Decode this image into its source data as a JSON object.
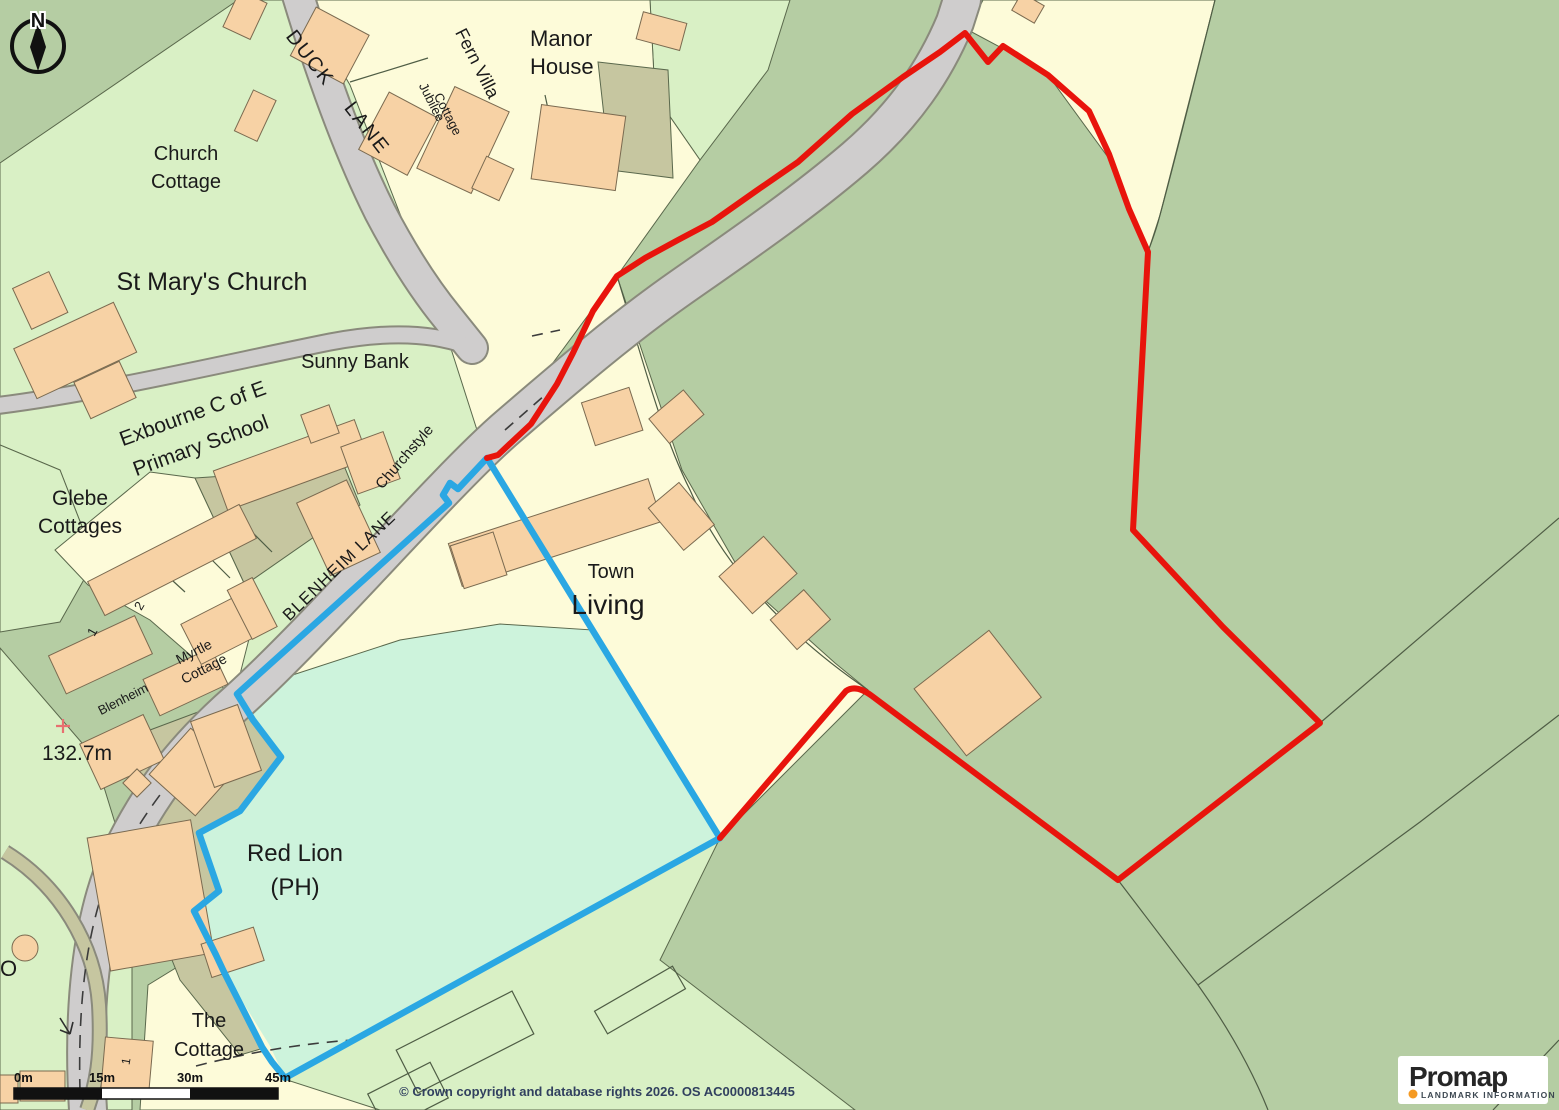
{
  "map_labels": {
    "duck_lane_1": "DUCK",
    "duck_lane_2": "LANE",
    "fern_villa": "Fern Villa",
    "jubilee_1": "Jubilee",
    "jubilee_2": "Cottage",
    "manor_1": "Manor",
    "manor_2": "House",
    "church_cottage_1": "Church",
    "church_cottage_2": "Cottage",
    "st_marys": "St Mary's Church",
    "school_1": "Exbourne C of E",
    "school_2": "Primary School",
    "sunny_bank": "Sunny Bank",
    "churchstyle": "Churchstyle",
    "glebe_1": "Glebe",
    "glebe_2": "Cottages",
    "blenheim_lane": "BLENHEIM LANE",
    "num_2": "2",
    "num_1": "1",
    "myrtle_1": "Myrtle",
    "myrtle_2": "Cottage",
    "blenheim": "Blenheim",
    "spot_height": "132.7m",
    "town": "Town",
    "living": "Living",
    "red_lion_1": "Red Lion",
    "red_lion_2": "(PH)",
    "the_cottage_1": "The",
    "the_cottage_2": "Cottage",
    "plot_1": "1",
    "o_partial": "O"
  },
  "compass": {
    "north": "N"
  },
  "scale_bar": {
    "ticks": [
      "0m",
      "15m",
      "30m",
      "45m"
    ]
  },
  "footer": {
    "copyright": "© Crown copyright and database rights 2026. OS AC0000813445"
  },
  "logo": {
    "brand": "Promap",
    "subtitle": "LANDMARK INFORMATION"
  },
  "colors": {
    "field_green": "#b5cda3",
    "light_green": "#d9f0c5",
    "parcel_yellow": "#fdfbd9",
    "mint_green": "#cdf3dc",
    "building_peach": "#f7d2a5",
    "yard_khaki": "#c6c6a0",
    "road_grey": "#cfcdcd",
    "boundary_red": "#e8140c",
    "boundary_blue": "#2aa7e3",
    "label_text": "#1a1a1a",
    "copyright_text": "#31405f",
    "logo_orange": "#f59a23"
  }
}
